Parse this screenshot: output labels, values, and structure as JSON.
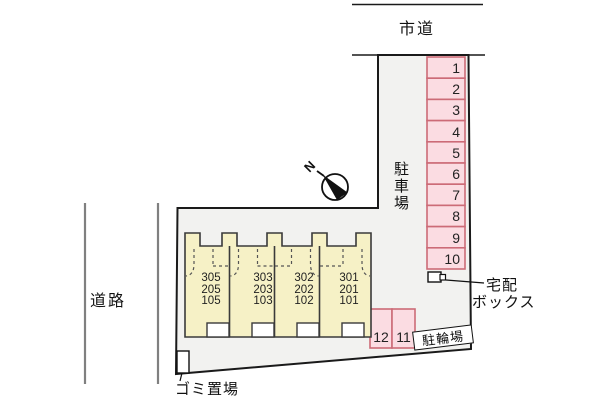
{
  "title": "site-plan",
  "roads": {
    "top_label": "市道",
    "left_label": "道路"
  },
  "parking": {
    "label": "駐車場",
    "stalls": [
      "1",
      "2",
      "3",
      "4",
      "5",
      "6",
      "7",
      "8",
      "9",
      "10"
    ]
  },
  "bike_parking": {
    "label": "駐輪場",
    "stalls": [
      "12",
      "11"
    ]
  },
  "delivery_box": {
    "label_line1": "宅配",
    "label_line2": "ボックス"
  },
  "garbage": {
    "label": "ゴミ置場"
  },
  "building": {
    "units": [
      {
        "rooms": [
          "305",
          "205",
          "105"
        ]
      },
      {
        "rooms": [
          "303",
          "203",
          "103"
        ]
      },
      {
        "rooms": [
          "302",
          "202",
          "102"
        ]
      },
      {
        "rooms": [
          "301",
          "201",
          "101"
        ]
      }
    ]
  },
  "compass": {
    "letter": "N"
  },
  "colors": {
    "site_fill": "#f2f2f0",
    "building_fill": "#f6f1c6",
    "building_stroke": "#3a3a3a",
    "stall_fill": "#fbdce2",
    "stall_stroke": "#cc6b77",
    "boundary": "#1a1a1a",
    "road_gray": "#808080"
  }
}
